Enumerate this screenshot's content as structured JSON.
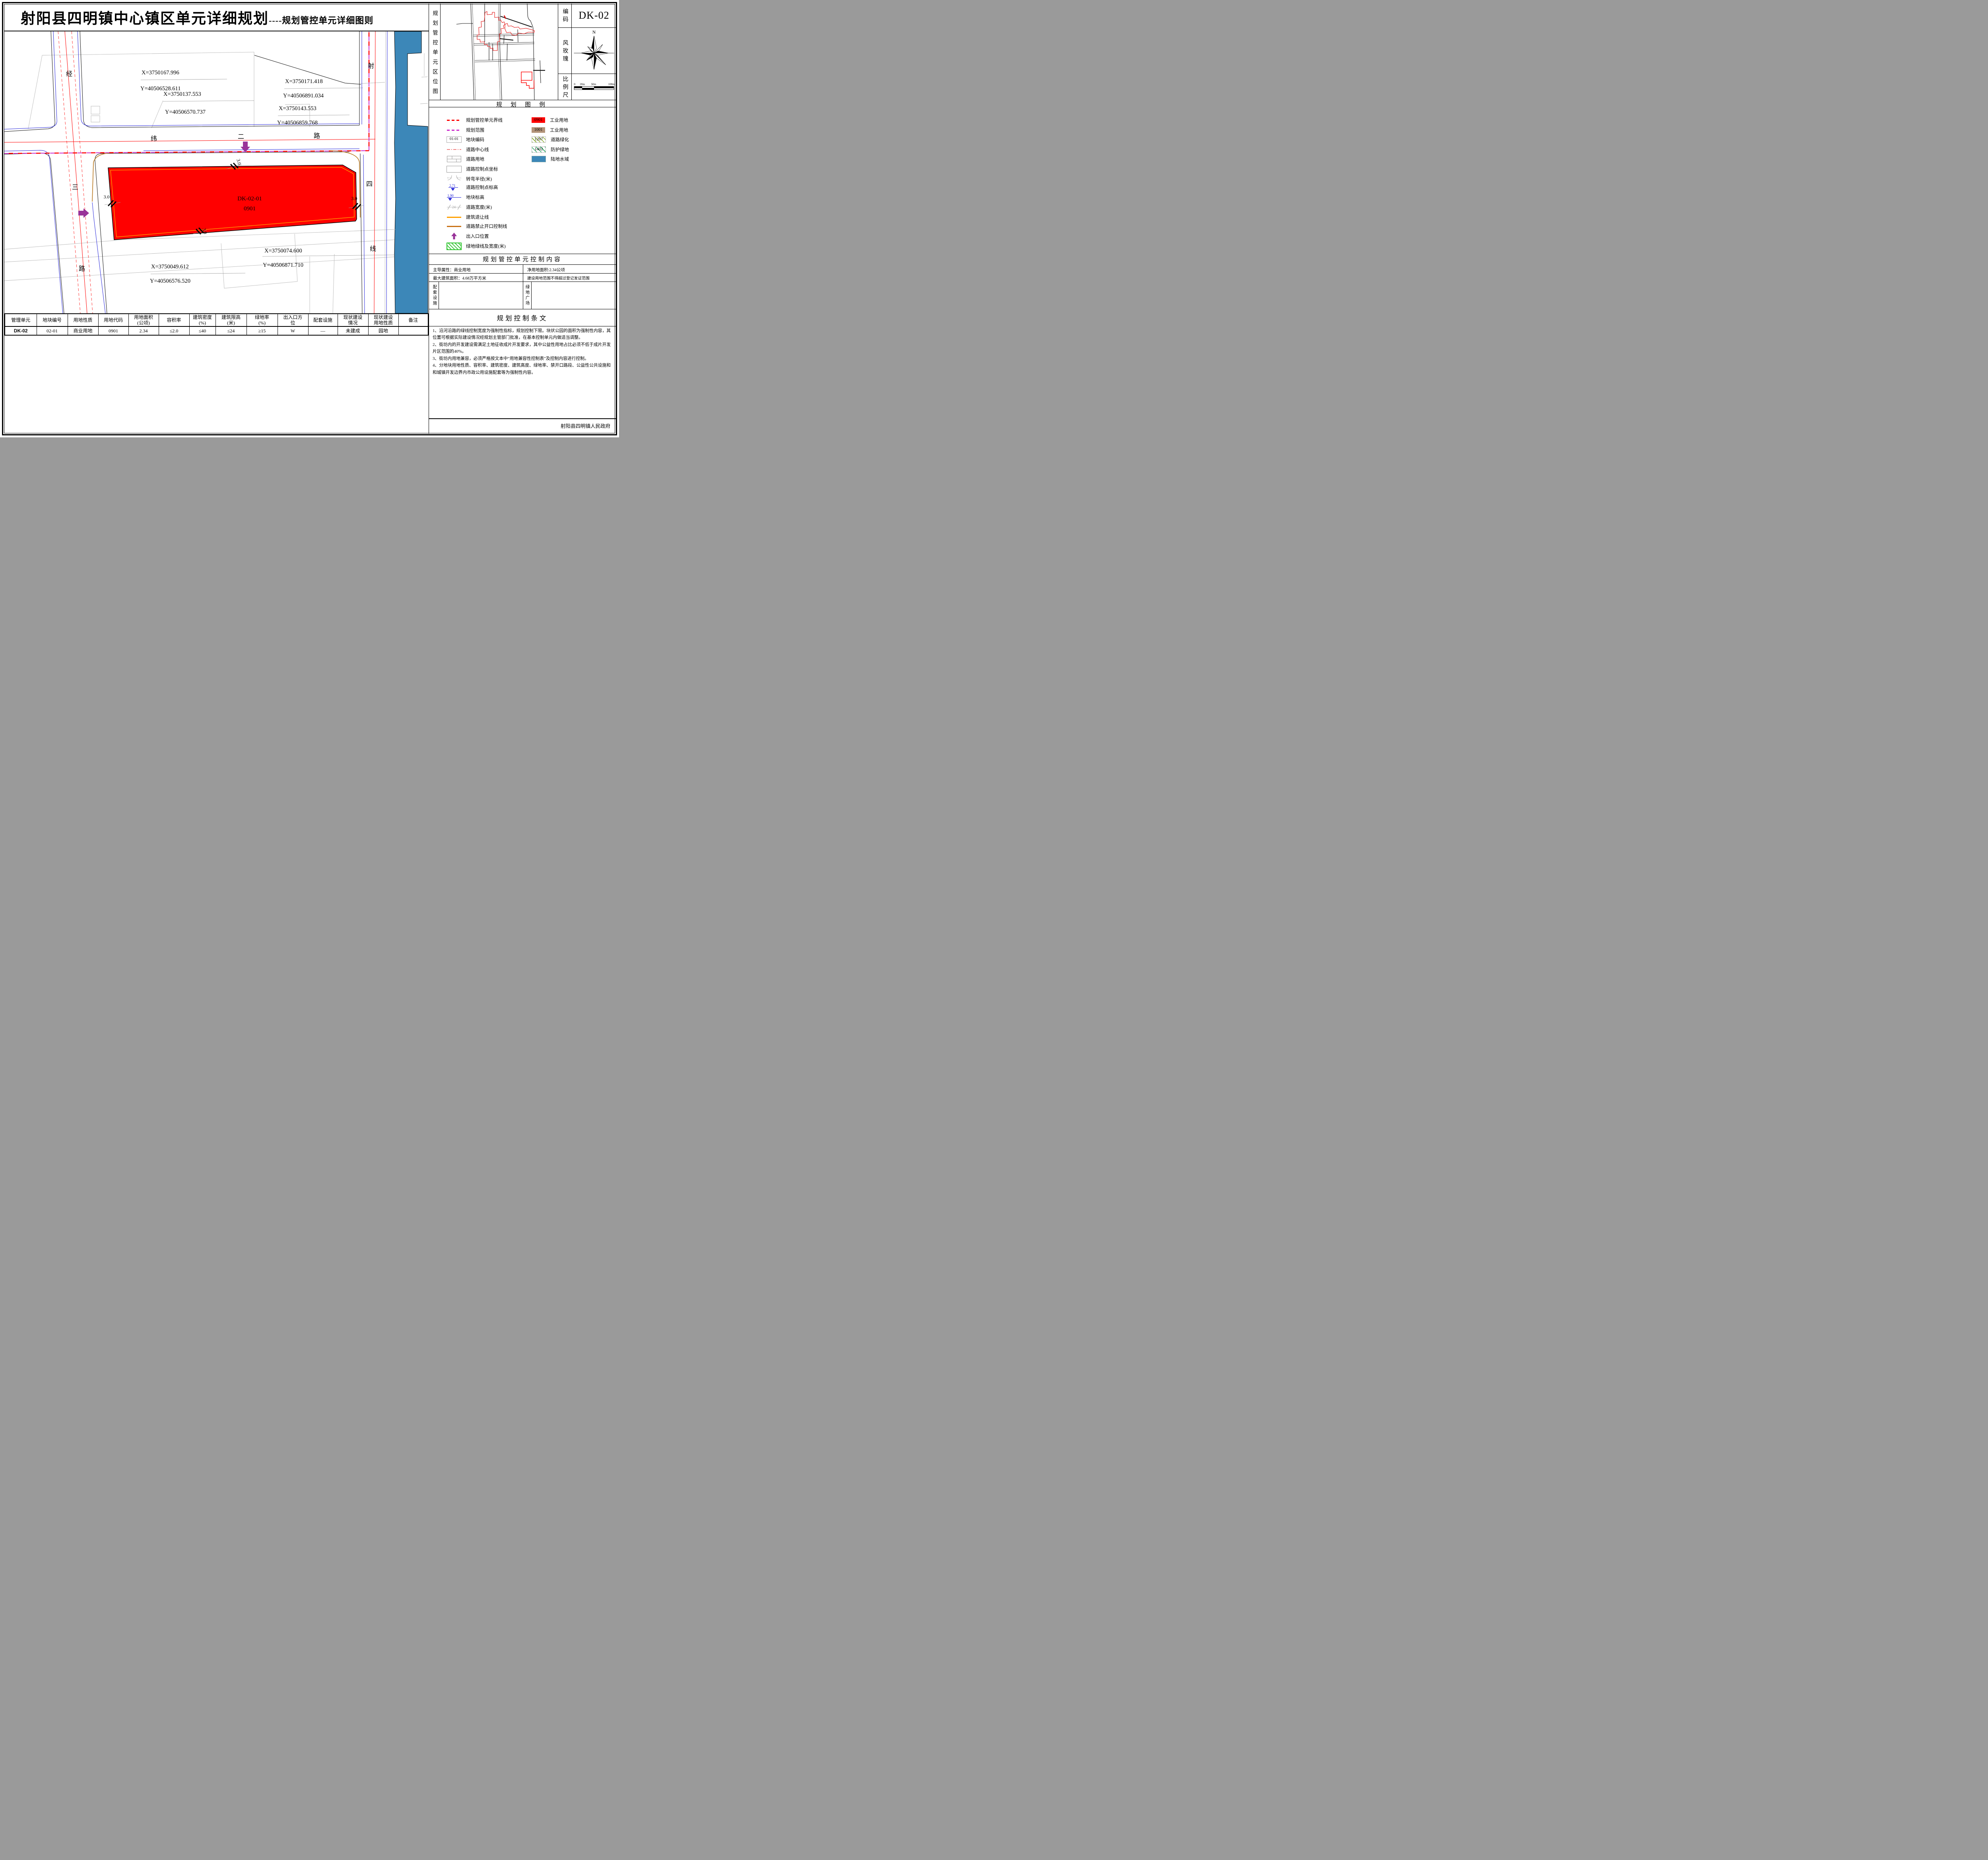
{
  "title": {
    "main": "射阳县四明镇中心镇区单元详细规划",
    "sub": "----规划管控单元详细图则"
  },
  "info_panel": {
    "location_label": "规划管控单元区位图",
    "code_label": "编码",
    "code_value": "DK-02",
    "wind_rose_label": "风玫瑰",
    "north": "N",
    "scale_label": "比例尺",
    "scale_ticks": [
      "0",
      "20m",
      "50m",
      "100m"
    ]
  },
  "legend": {
    "title": "规 划 图 例",
    "left_items": [
      "规划管控单元界线",
      "规划范围",
      "地块编码",
      "道路中心线",
      "道路用地",
      "道路控制点坐标",
      "转弯半径(米)",
      "道路控制点标高",
      "地块标高",
      "道路宽度(米)",
      "建筑退让线",
      "道路禁止开口控制线",
      "出入口位置",
      "绿地绿线及宽度(米)"
    ],
    "icon_texts": {
      "plot_code": "01-01",
      "radius_l": "R=15",
      "radius_r": "R=15",
      "elev_road": "2.71",
      "elev_plot": "1.90",
      "road_width": "24"
    },
    "right_items": [
      {
        "code": "0901",
        "label": "工业用地"
      },
      {
        "code": "1001",
        "label": "工业用地"
      },
      {
        "code": "1207",
        "label": "道路绿化"
      },
      {
        "code": "1402",
        "label": "防护绿地"
      },
      {
        "code": "",
        "label": "陆地水域"
      }
    ]
  },
  "map": {
    "road_jing": [
      "经",
      "三",
      "路"
    ],
    "road_wei": [
      "纬",
      "二",
      "路"
    ],
    "road_she": [
      "射",
      "四",
      "线"
    ],
    "parcel_code": "DK-02-01",
    "parcel_use": "0901",
    "dim": "3.0",
    "coords": [
      {
        "x": "X=3750167.996",
        "y": "Y=40506528.611"
      },
      {
        "x": "X=3750137.553",
        "y": "Y=40506570.737"
      },
      {
        "x": "X=3750171.418",
        "y": "Y=40506891.034"
      },
      {
        "x": "X=3750143.553",
        "y": "Y=40506859.768"
      },
      {
        "x": "X=3750074.600",
        "y": "Y=40506871.710"
      },
      {
        "x": "X=3750049.612",
        "y": "Y=40506576.520"
      }
    ]
  },
  "control_content": {
    "title": "规划管控单元控制内容",
    "r1c1": "主导属性：商业用地",
    "r1c2": "净用地面积:2.34公顷",
    "r2c1": "最大建筑面积：4.68万平方米",
    "r2c2": "建设用地范围不得超过登记发证范围",
    "r3_left": "配套设施",
    "r3_right": "绿地广场"
  },
  "provisions": {
    "title": "规划控制条文",
    "items": [
      "1、沿河沿路的绿线控制宽度为强制性指标，规划控制下限。块状公园的面积为强制性内容，其位置可根据实际建设情况经规划主管部门批准，在基本控制单元内做适当调整。",
      "2、街坊内的开发建设需满足土地征收成片开发要求，其中公益性用地占比必须不低于成片开发片区范围的40%。",
      "3、街坊内用地兼容，必须严格按文本中“用地兼容性控制表”及控制内容进行控制。",
      "4、分地块用地性质、容积率、建筑密度、建筑高度、绿地率、禁开口路段、公益性公共设施和和城镇开发边界内市政公用设施配套等为强制性内容。"
    ]
  },
  "bottom_table": {
    "headers": [
      "管理单元",
      "地块编号",
      "用地性质",
      "用地代码",
      "用地面积\n(公顷)",
      "容积率",
      "建筑密度\n(%)",
      "建筑限高\n(米)",
      "绿地率\n(%)",
      "出入口方\n位",
      "配套设施",
      "现状建设\n情况",
      "现状建设\n用地性质",
      "备注"
    ],
    "row": [
      "DK-02",
      "02-01",
      "商业用地",
      "0901",
      "2.34",
      "≤2.0",
      "≤40",
      "≤24",
      "≥15",
      "W",
      "—",
      "未建成",
      "园地",
      ""
    ]
  },
  "footer": "射阳县四明镇人民政府",
  "colors": {
    "parcel_0901": "#ff0000",
    "use_1001": "#b29379",
    "water": "#3c87b8",
    "boundary_unit": "#ff0000",
    "boundary_plan": "#cc2ccc",
    "setback": "#ffa000",
    "no_open_line": "#c87114",
    "entrance_arrow": "#993399",
    "road_center": "#ff0000",
    "road_blue": "#2626d9",
    "hatch_1207": "#86a825",
    "hatch_1402": "#1fa35c"
  }
}
